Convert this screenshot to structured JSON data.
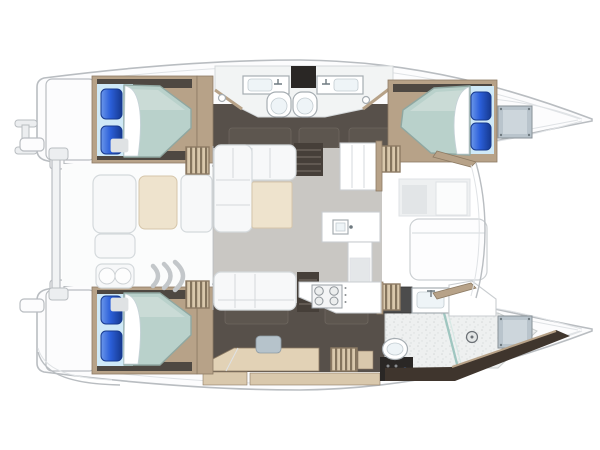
{
  "meta": {
    "label": "Catamaran sailing yacht interior layout - top-down floor plan, bows to the right",
    "type": "floor-plan"
  },
  "colors": {
    "bg": "#ffffff",
    "line": "#b9bdc1",
    "line_soft": "#dfe2e5",
    "deck": "#fcfcfd",
    "deck_panel": "#eef0f1",
    "deck_panel2": "#e2e5e7",
    "dark_floor": "#57504a",
    "dark_seat": "#5d564f",
    "dark_deep": "#463f39",
    "wood": "#b7a288",
    "wood_dark": "#8d7b64",
    "wood_light": "#d9c8ac",
    "wood_pale": "#e2d2b6",
    "stair_dark": "#84745d",
    "mattress": "#b9d1cb",
    "mattress_hi": "#d2e1dc",
    "mattress_line": "#8fa7a1",
    "sheet": "#cfe9f7",
    "pillow": "#2b5fd9",
    "pillow_deep": "#16398f",
    "pillow_hi": "#6b97ea",
    "salon_floor": "#c9c7c3",
    "sofa": "#f7f8f9",
    "sofa_line": "#d4d9dc",
    "cream": "#eee3cd",
    "cream_line": "#d6c6aa",
    "counter": "#ffffff",
    "counter_line": "#c9cdd0",
    "steel": "#4c4c4c",
    "bath_floor": "#eef0f0",
    "bath_line": "#c8cccc",
    "glass": "#9fc6c0",
    "window": "#b9c4cc",
    "window_in": "#cdd6dc",
    "window_line": "#899298",
    "fixture_line": "#a6adb2",
    "dark_box": "#2a2725",
    "stool": "#b6c3cb",
    "dark_wedge": "#3f352d"
  },
  "scene": {
    "hulls": [
      {
        "name": "port-hull",
        "rooms": [
          {
            "name": "aft-double-cabin",
            "items": [
              "double-berth",
              "pillow",
              "pillow",
              "duvet-fold",
              "sheet"
            ]
          },
          {
            "name": "twin-heads",
            "items": [
              "washbasin",
              "washbasin",
              "cabinet",
              "toilet",
              "toilet",
              "drain",
              "drain"
            ]
          },
          {
            "name": "forward-double-cabin",
            "items": [
              "double-berth",
              "pillow",
              "pillow",
              "duvet-fold",
              "deck-hatch"
            ]
          }
        ]
      },
      {
        "name": "starboard-hull",
        "rooms": [
          {
            "name": "aft-double-cabin",
            "items": [
              "double-berth",
              "pillow",
              "pillow",
              "duvet-fold",
              "sheet"
            ]
          },
          {
            "name": "office-dressing-area",
            "items": [
              "desk",
              "stool",
              "companionway-steps",
              "shelf"
            ]
          },
          {
            "name": "owner-bathroom",
            "items": [
              "vanity-counter",
              "washbasin",
              "shower-floor",
              "glass-partition",
              "drain",
              "toilet",
              "cistern-unit",
              "deck-hatch"
            ]
          }
        ]
      }
    ],
    "salon": {
      "items": [
        "l-shaped-sofa",
        "coffee-table",
        "aft-bench",
        "companionway-steps-x4",
        "down-steps-alcove-x2",
        "storage-backrests"
      ]
    },
    "galley": {
      "items": [
        "tall-cabinet",
        "island-counter",
        "sink",
        "fridge-front",
        "stove-four-burners"
      ]
    },
    "cockpit": {
      "items": [
        "bench-cushion",
        "table-cushion",
        "bench-cushion",
        "seat-cushion",
        "double-seat",
        "curved-steps"
      ]
    },
    "foredeck": {
      "items": [
        "locker-panel",
        "sun-lounger",
        "curved-coaming"
      ]
    },
    "exterior": {
      "items": [
        "transom-platform-port",
        "boarding-ladder",
        "transom-platform-starboard",
        "aft-crossbeam",
        "beam-clamps",
        "port-bow",
        "starboard-bow"
      ]
    },
    "counts": {
      "cabins": 3,
      "bathrooms": 3,
      "double-berths": 3,
      "pillows": 6,
      "stove-burners": 4
    }
  }
}
